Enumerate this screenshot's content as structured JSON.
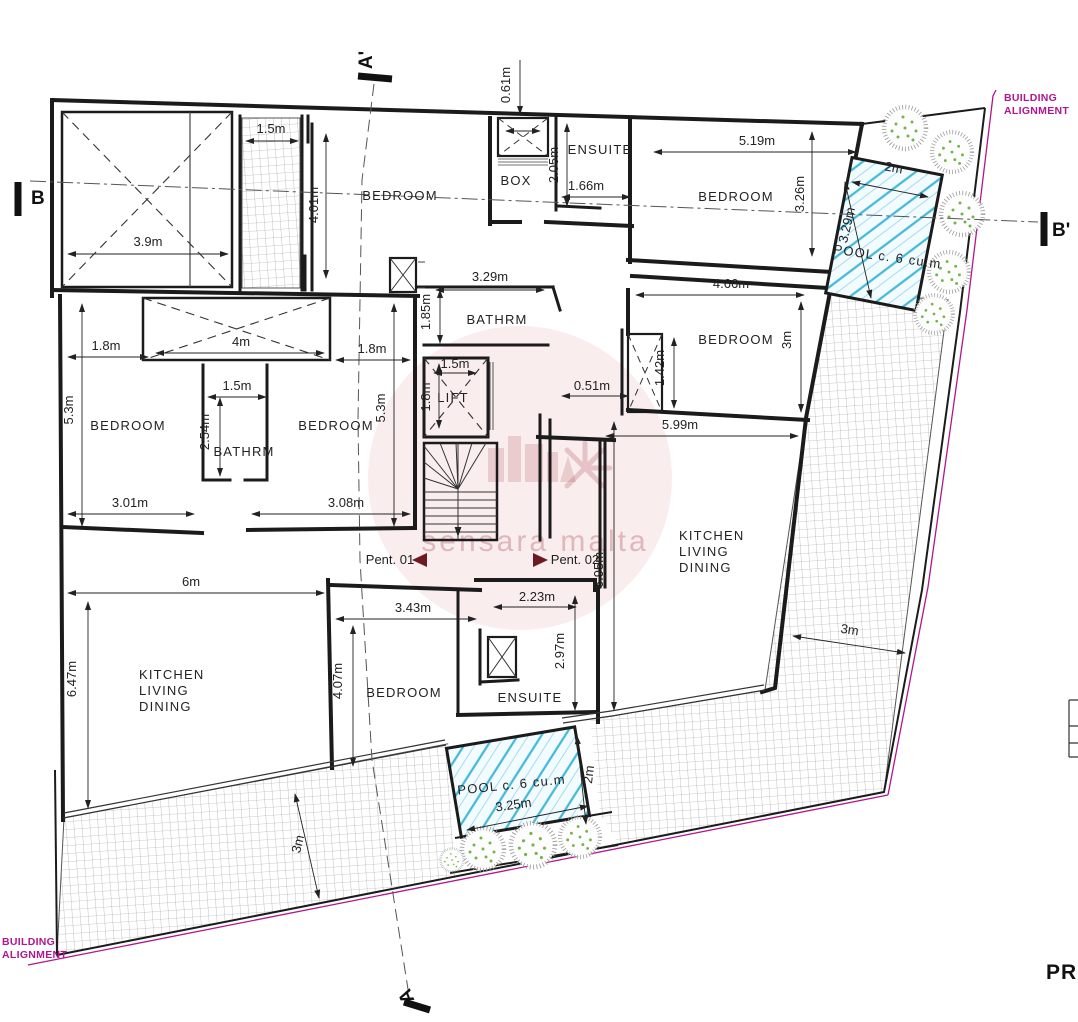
{
  "labels": {
    "building_alignment_line1": "BUILDING",
    "building_alignment_line2": "ALIGNMENT",
    "pent_01": "Pent. 01",
    "pent_02": "Pent. 02",
    "title_fragment": "PR",
    "watermark": "sensara malta"
  },
  "sections": {
    "a_top": "A'",
    "a_bottom": "A",
    "b_left": "B",
    "b_right": "B'"
  },
  "rooms": {
    "top_left_bedroom": "BEDROOM",
    "box_room": "BOX",
    "top_ensuite": "ENSUITE",
    "top_right_bedroom": "BEDROOM",
    "center_bathroom": "BATHRM",
    "lift": "LIFT",
    "left_bedroom": "BEDROOM",
    "left_bathroom": "BATHRM",
    "center_left_bedroom": "BEDROOM",
    "right_bedroom": "BEDROOM",
    "bottom_bedroom": "BEDROOM",
    "bottom_ensuite": "ENSUITE",
    "kitchen_right": [
      "KITCHEN",
      "LIVING",
      "DINING"
    ],
    "kitchen_left": [
      "KITCHEN",
      "LIVING",
      "DINING"
    ],
    "pool_top_right": "POOL c. 6 cu.m",
    "pool_bottom": "POOL c. 6 cu.m"
  },
  "dims": {
    "strip_width": "1.5m",
    "void_width": "3.9m",
    "strip_height": "4.01m",
    "box_offset": "0.61m",
    "ensuite_top_depth": "2.05m",
    "ensuite_top_width": "1.66m",
    "tr_bedroom_width": "5.19m",
    "tr_bedroom_depth": "3.26m",
    "pool_tr_width": "2m",
    "pool_tr_length": "3.29m",
    "center_bath_width": "3.29m",
    "center_bath_depth": "1.85m",
    "left_bath_width": "1.5m",
    "left_bath_depth": "2.54m",
    "void4_width": "4m",
    "left_offset": "1.8m",
    "right_offset": "1.8m",
    "left_depth": "5.3m",
    "center_depth": "5.3m",
    "left_bedroom_width": "3.01m",
    "center_bedroom_width": "3.08m",
    "lift_width": "1.5m",
    "lift_depth": "1.8m",
    "shaft_depth": "1.42m",
    "shaft_offset": "0.51m",
    "right_bedroom_depth": "3m",
    "right_bedroom_width": "4.66m",
    "kitchen_right_width": "5.99m",
    "kitchen_right_depth": "6.95m",
    "kitchen_left_width": "6m",
    "kitchen_left_depth": "6.47m",
    "bottom_bedroom_width": "3.43m",
    "bottom_bedroom_depth": "4.07m",
    "bottom_ensuite_width": "2.23m",
    "bottom_ensuite_depth": "2.97m",
    "pool_b_length": "3.25m",
    "pool_b_width": "2m",
    "terrace_bottom": "3m",
    "terrace_right": "3m"
  },
  "colors": {
    "alignment_magenta": "#b0168e",
    "pool_blue": "#45b9da",
    "wall_black": "#1b1b1b",
    "plant_green": "#74b44a"
  }
}
